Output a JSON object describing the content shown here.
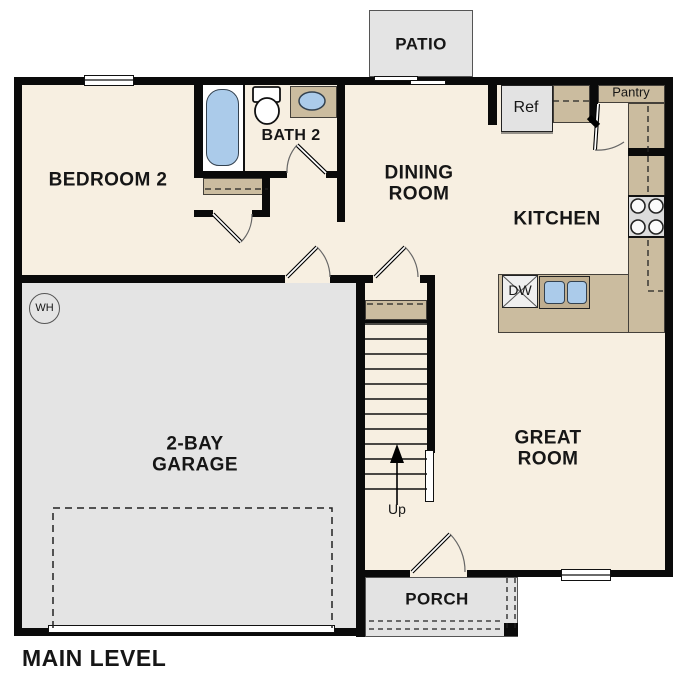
{
  "plan_title": "MAIN LEVEL",
  "rooms": {
    "patio": "PATIO",
    "bedroom2": "BEDROOM 2",
    "bath2": "BATH 2",
    "dining": "DINING\nROOM",
    "kitchen": "KITCHEN",
    "great_room": "GREAT\nROOM",
    "garage": "2-BAY\nGARAGE",
    "porch": "PORCH"
  },
  "fixtures": {
    "refrigerator": "Ref",
    "pantry": "Pantry",
    "dishwasher": "DW",
    "water_heater": "WH",
    "stairs_direction": "Up"
  },
  "colors": {
    "floor_cream": "#f7efe1",
    "garage_gray": "#e4e4e4",
    "porch_gray": "#e3e3e3",
    "counter_tan": "#cbbc9f",
    "sink_surround_tan": "#bfae90",
    "fixture_blue": "#abcbea",
    "appliance_gray": "#dedede",
    "wall_black": "#0a0a0a"
  }
}
